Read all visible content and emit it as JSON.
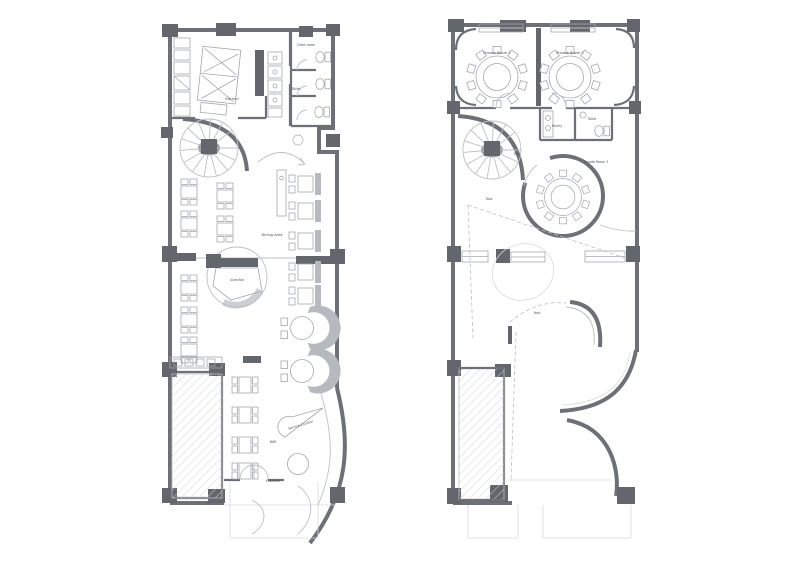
{
  "page": {
    "background": "#ffffff"
  },
  "colors": {
    "wall": "#6d7076",
    "column": "#63666c",
    "line_light": "#bcbfc4",
    "line_faint": "#d8dade",
    "furniture": "#a3a7ac",
    "banquette": "#b6bac0",
    "hatch": "#cdd0d4",
    "label": "#4a4d52"
  },
  "plans": [
    {
      "id": "lower-floor-plan",
      "labels": {
        "kitchen": "Kitchen",
        "clean_room": "Clean room",
        "toilet": "Toilet",
        "dining_area": "Dining Area",
        "juice_bar": "Juice Bar",
        "service_counter": "Service Counter",
        "bar": "BAR",
        "entrance": "Entrance"
      }
    },
    {
      "id": "upper-floor-plan",
      "labels": {
        "private_room_1": "Private Room 1",
        "private_room_2": "Private Room 2",
        "private_room_3": "Private Room 3",
        "pantry": "Pantry",
        "toilet": "Toilet",
        "stair_down": "Dn",
        "void_a": "Void",
        "void_b": "Void"
      }
    }
  ]
}
